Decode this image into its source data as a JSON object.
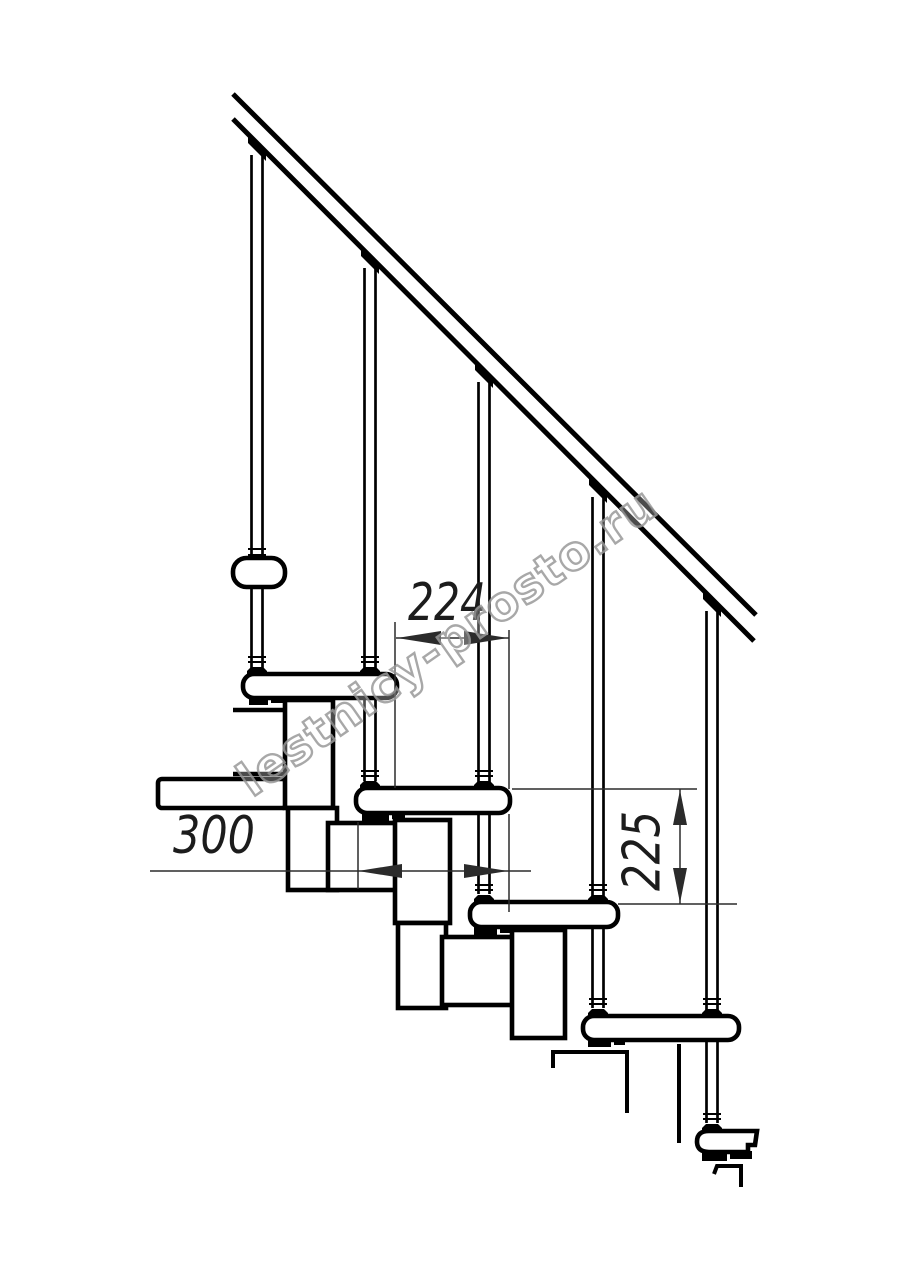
{
  "drawing": {
    "type": "modular-staircase-side-elevation",
    "background": "#ffffff",
    "line_color": "#000000",
    "dimension_color": "#2b2b2b",
    "dimensions": {
      "step_run": {
        "label": "224",
        "orientation": "horizontal"
      },
      "tread_depth": {
        "label": "300",
        "orientation": "horizontal"
      },
      "step_rise": {
        "label": "225",
        "orientation": "vertical"
      }
    },
    "counts": {
      "treads_visible": 5,
      "balusters": 5
    },
    "watermark": {
      "text": "lestnicy-prosto.ru",
      "color": "#9a9a9a"
    }
  }
}
